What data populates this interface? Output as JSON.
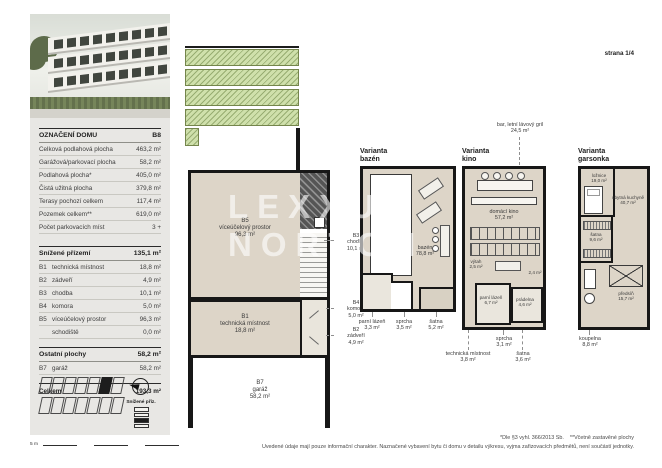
{
  "page": {
    "strana": "strana 1/4",
    "scale_label": "5 m",
    "note_top": "*Dle §3 vyhl. 366/2013 Sb.    **Včetně zastavěné plochy",
    "note_bottom": "Uvedené údaje mají pouze informační charakter. Naznačené vybavení bytu či domu v detailu výkresu, vyjma zařizovacích předmětů, není součástí jednotky."
  },
  "watermark": {
    "text": "LEXXUS\nNORTON"
  },
  "sidebar": {
    "table1": {
      "header": {
        "label": "OZNAČENÍ DOMU",
        "value": "B8"
      },
      "rows": [
        {
          "label": "Celková podlahová plocha",
          "value": "463,2 m²"
        },
        {
          "label": "Garážová/parkovací plocha",
          "value": "58,2 m²"
        },
        {
          "label": "Podlahová plocha*",
          "value": "405,0 m²"
        },
        {
          "label": "Čistá užitná plocha",
          "value": "379,8 m²"
        },
        {
          "label": "Terasy pochozí celkem",
          "value": "117,4 m²"
        },
        {
          "label": "Pozemek celkem**",
          "value": "619,0 m²"
        },
        {
          "label": "Počet parkovacích míst",
          "value": "3 +"
        }
      ]
    },
    "table2": {
      "header": {
        "label": "Snížené přízemí",
        "value": "135,1 m²"
      },
      "rows": [
        {
          "code": "B1",
          "label": "technická místnost",
          "value": "18,8 m²"
        },
        {
          "code": "B2",
          "label": "zádveří",
          "value": "4,9 m²"
        },
        {
          "code": "B3",
          "label": "chodba",
          "value": "10,1 m²"
        },
        {
          "code": "B4",
          "label": "komora",
          "value": "5,0 m²"
        },
        {
          "code": "B5",
          "label": "víceúčelový prostor",
          "value": "96,3 m²"
        },
        {
          "code": "",
          "label": "schodiště",
          "value": "0,0 m²"
        }
      ],
      "subheader": {
        "label": "Ostatní plochy",
        "value": "58,2 m²"
      },
      "rows2": [
        {
          "code": "B7",
          "label": "garáž",
          "value": "58,2 m²"
        }
      ],
      "total": {
        "label": "Celkem",
        "value": "193,3 m²"
      }
    },
    "floor_badge": "Snížené příz."
  },
  "main_plan": {
    "b5": "B5\nvíceúčelový prostor\n96,3 m²",
    "b1": "B1\ntechnická místnost\n18,8 m²",
    "b7": "B7\ngaráž\n58,2 m²",
    "b3": "B3\nchodba\n10,1 m²",
    "b4": "B4\nkomora\n5,0 m²",
    "b2": "B2\nzádveří\n4,9 m²"
  },
  "variants": {
    "bazen": {
      "title": "Varianta\nbazén",
      "room": "bazén\n78,8 m²",
      "below": [
        "parní lázeň\n3,3 m²",
        "sprcha\n3,5 m²",
        "šatna\n5,2 m²"
      ]
    },
    "kino": {
      "title": "Varianta\nkino",
      "annotation": "bar, letní lávový gril\n24,5 m²",
      "room": "domácí kino\n57,2 m²",
      "vytah": "výtah\n2,5 m²",
      "parni": "parní lázeň\n6,7 m²",
      "pradelna": "prádelna\n4,6 m²",
      "small": "2,4 m²",
      "below": [
        "sprcha\n3,1 m²",
        "technická místnost\n3,8 m²",
        "šatna\n3,6 m²"
      ]
    },
    "garsonka": {
      "title": "Varianta\ngarsonka",
      "loznice": "ložnice\n19,0 m²",
      "kuchyne": "obytná kuchyně\n40,7 m²",
      "satna": "šatna\n9,6 m²",
      "predsin": "předsíň\n15,7 m²",
      "below": [
        "koupelna\n8,8 m²"
      ]
    }
  },
  "colors": {
    "wall": "#171717",
    "floor": "#DDD5C8",
    "garden": "#CFE0AB",
    "sidebar_bg": "#E8E7E4"
  }
}
